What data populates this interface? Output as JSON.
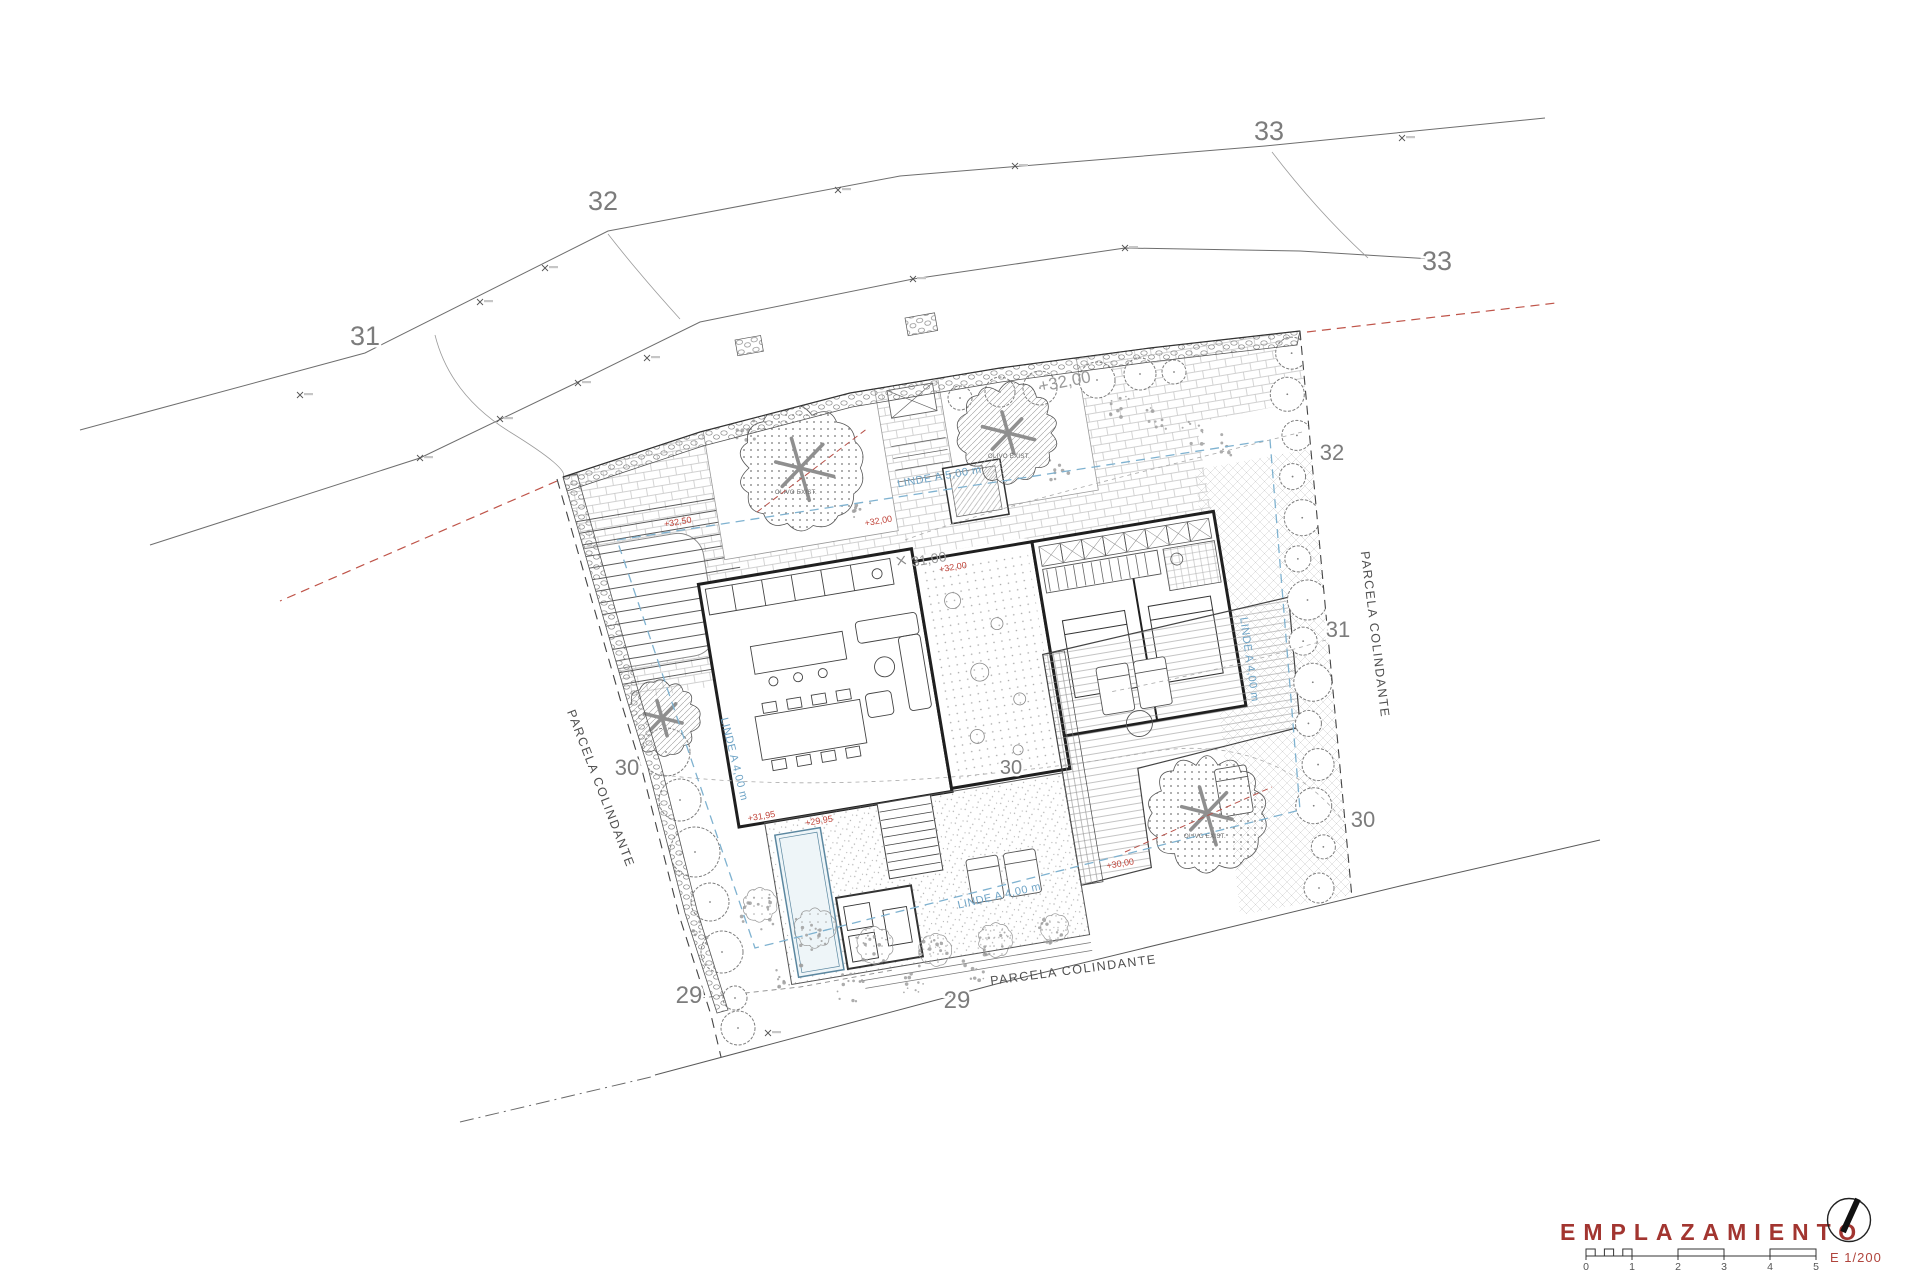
{
  "title": {
    "text": "EMPLAZAMIENTO",
    "scale_text": "E 1/200"
  },
  "scale_bar": {
    "numbers": [
      "0",
      "1",
      "2",
      "3",
      "4",
      "5"
    ]
  },
  "colors": {
    "title_red": "#a23530",
    "accent_red": "#c0443a",
    "setback_blue": "#7fb2d0",
    "contour_gray": "#7c7c7c"
  },
  "contours": {
    "labels": [
      {
        "t": "31",
        "x": 365,
        "y": 345,
        "s": 27
      },
      {
        "t": "32",
        "x": 603,
        "y": 210,
        "s": 27
      },
      {
        "t": "33",
        "x": 1269,
        "y": 140,
        "s": 27
      },
      {
        "t": "33",
        "x": 1437,
        "y": 270,
        "s": 27
      },
      {
        "t": "32",
        "x": 1332,
        "y": 460,
        "s": 22
      },
      {
        "t": "31",
        "x": 1338,
        "y": 637,
        "s": 22
      },
      {
        "t": "30",
        "x": 1363,
        "y": 827,
        "s": 22
      },
      {
        "t": "30",
        "x": 627,
        "y": 775,
        "s": 22
      },
      {
        "t": "30",
        "x": 1011,
        "y": 774,
        "s": 20
      },
      {
        "t": "29",
        "x": 689,
        "y": 1003,
        "s": 24
      },
      {
        "t": "29",
        "x": 957,
        "y": 1008,
        "s": 24
      }
    ]
  },
  "parcels": {
    "left": "PARCELA COLINDANTE",
    "right": "PARCELA COLINDANTE",
    "bottom": "PARCELA COLINDANTE"
  },
  "setbacks": {
    "front": "LINDE A 5,00 m",
    "side_left": "LINDE A 4,00 m",
    "side_right": "LINDE A 4,00 m",
    "rear": "LINDE A 4,00 m"
  },
  "levels": {
    "street": "+32,00",
    "entry": "31,00",
    "spots": [
      {
        "t": "+32,50"
      },
      {
        "t": "+32,00"
      },
      {
        "t": "+32,00"
      },
      {
        "t": "+31,95"
      },
      {
        "t": "+29,95"
      },
      {
        "t": "+30,00"
      }
    ]
  },
  "trees": {
    "labels": [
      {
        "t": "OLIVO EXIST."
      },
      {
        "t": "OLIVO EXIST."
      },
      {
        "t": "OLIVO EXIST."
      }
    ]
  }
}
